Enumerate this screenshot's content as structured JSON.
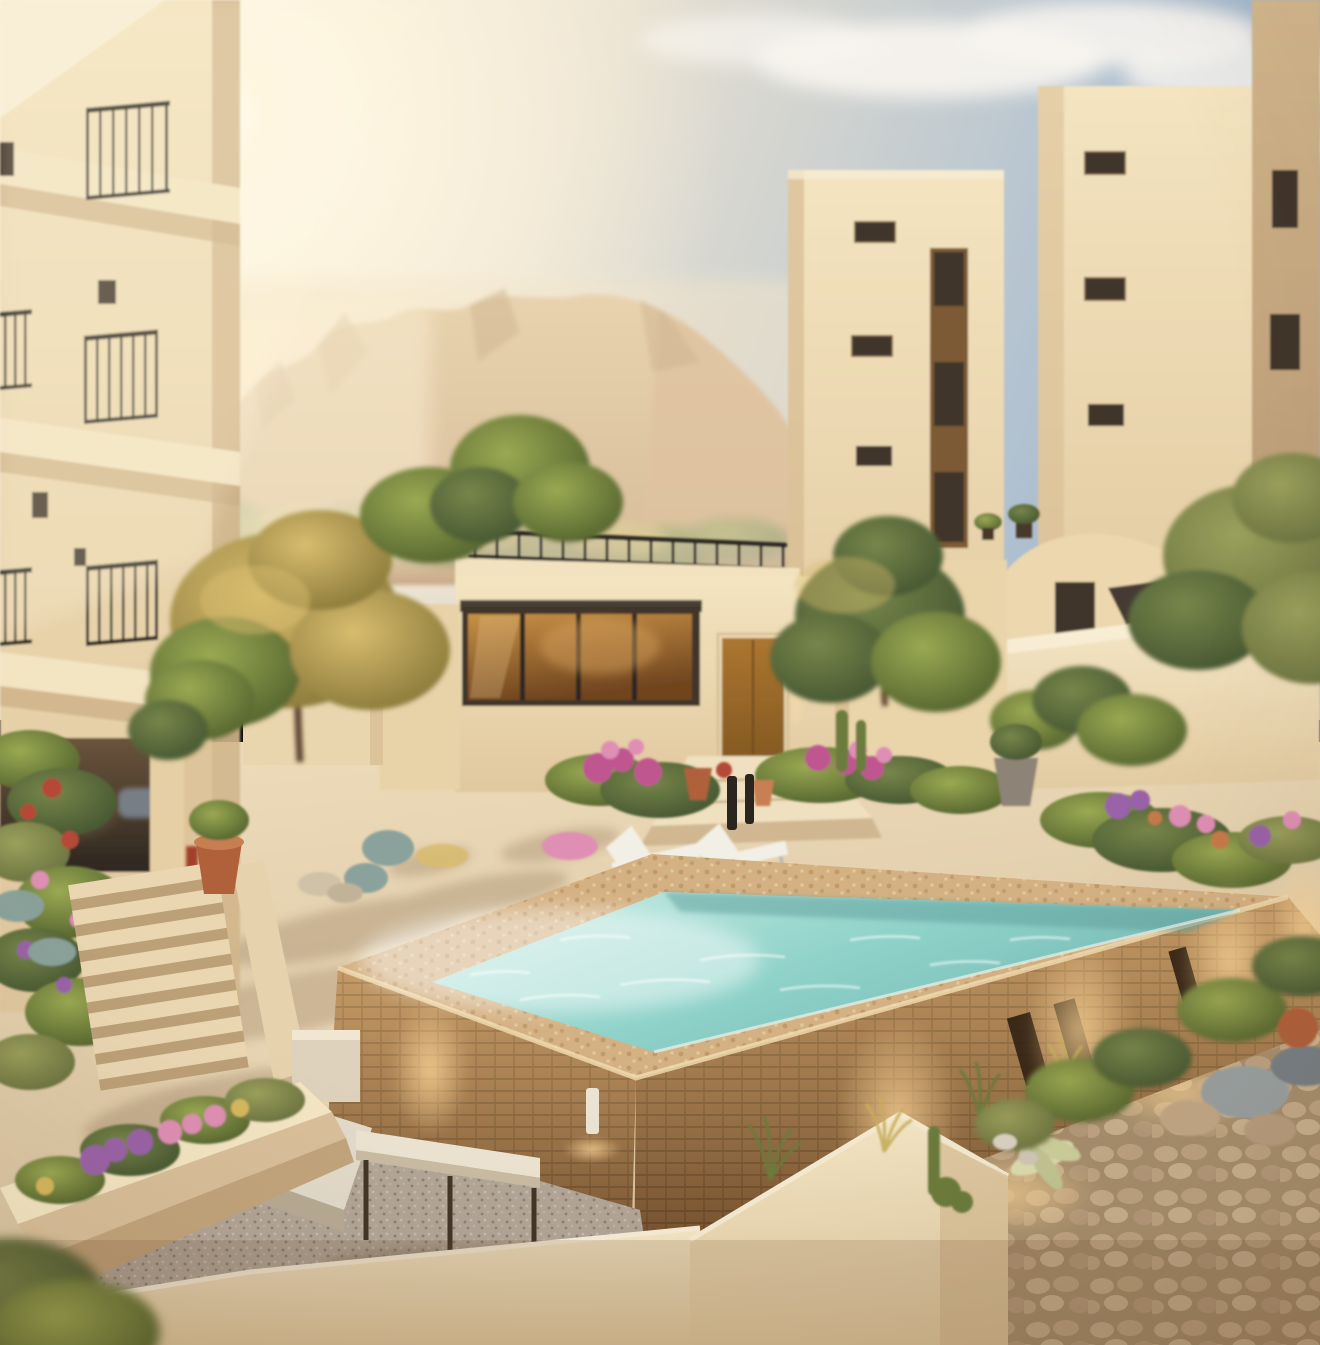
{
  "image": {
    "kind": "photorealistic architectural rendering",
    "subject": "sunlit desert courtyard of a cream stucco apartment complex with a raised brick swimming pool, mountains behind",
    "width_px": 1320,
    "height_px": 1345
  },
  "scene": {
    "regions": [
      "sky",
      "sun-glow",
      "clouds",
      "desert-mountains",
      "foothill-greenery",
      "left-apartment-building",
      "balcony-railings",
      "shaded-walkway",
      "right-apartment-towers",
      "tower-windows",
      "roof-deck-awning",
      "terrace-sofa",
      "central-clubhouse",
      "roof-terrace-railing",
      "picture-window",
      "entry-door",
      "entry-steps",
      "courtyard-garden",
      "trees",
      "flower-beds",
      "terracotta-pot",
      "stone-stairs",
      "raised-brick-pool",
      "pool-water",
      "pool-coping",
      "wall-niches",
      "uplights",
      "lounge-chairs",
      "gravel-patio",
      "garden-bench",
      "patio-table",
      "planter-wall",
      "foreground-wall",
      "rock-cluster",
      "yucca-plants",
      "cobblestone-path"
    ]
  },
  "palette": {
    "sky_warm": "#f7eedb",
    "sky_mid": "#e9e1d1",
    "sky_blue": "#9db6cf",
    "cloud_white": "#f8f5ef",
    "cloud_shadow": "#9db3c9",
    "sun_core": "#fffdf4",
    "sun_glow": "#fff6e0",
    "mountain_top": "#dcc093",
    "mountain_base": "#b99168",
    "ridge_front_top": "#c9a577",
    "ridge_front_base": "#a98058",
    "ridge_shadow": "#a57d52",
    "haze": "#f4e6ca",
    "stucco_light": "#f4e4c0",
    "stucco_base": "#e0c89e",
    "stucco_bright": "#f8eed6",
    "stucco_shade": "#d2b68c",
    "stucco_deep": "#b49571",
    "window_dark": "#41342a",
    "recess_brown": "#7b5a35",
    "glass_amber": "#c79045",
    "glass_deep": "#70451f",
    "door_wood": "#ac7630",
    "door_deep": "#855a22",
    "railing": "#2b2520",
    "awning": "#3a3129",
    "sofa_blue": "#8b9cb2",
    "sofa_blue_light": "#a9b7c7",
    "furniture_dark": "#46392c",
    "corridor_dark": "#2e2720",
    "corridor_warm": "#6b543c",
    "tree_gold": "#d8bc6e",
    "tree_gold_deep": "#8a7a3a",
    "tree_green": "#9aa952",
    "tree_green_deep": "#55652f",
    "tree_dark": "#77864a",
    "tree_dark_deep": "#465732",
    "tree_olive": "#9aa05c",
    "tree_olive_deep": "#6b7340",
    "trunk": "#5f4530",
    "flower_magenta": "#bf5690",
    "flower_pink": "#df8fb4",
    "flower_purple": "#9a62a8",
    "flower_red": "#b44a38",
    "flower_yellow": "#d4b85e",
    "agave_blue": "#8aa29b",
    "terracotta": "#b0613a",
    "terracotta_light": "#c77f52",
    "pot_grey": "#8d8376",
    "paving_light": "#eedcba",
    "paving_base": "#d5bf9c",
    "shadow_warm": "#8a7054",
    "cobble_base": "#a8906f",
    "cobble_stone": "#c6ad8c",
    "gravel_base": "#b2a698",
    "gravel_dark": "#8f8275",
    "brick_base": "#9c6a3e",
    "brick_mortar": "#744d2a",
    "brick_glow": "#ffdf9e",
    "brick_shadow": "#3a2410",
    "coping_sand": "#d4b183",
    "coping_dot": "#c09a68",
    "water_light": "#cdeee6",
    "water_mid": "#8fd2c9",
    "water_deep": "#74bab6",
    "sparkle": "#ffffff",
    "wall_cream": "#f6e8c8",
    "wall_cream_deep": "#e2cba2",
    "bench_white": "#e3dbcb",
    "table_top": "#ece4d2",
    "leg_dark": "#413528",
    "stone_grey": "#9aa2a4",
    "stone_dark": "#778086",
    "stone_tan": "#c4aa88",
    "yucca_pale": "#dfe0b4",
    "cactus_green": "#6c7c3e",
    "glow_warm": "#ffd89a",
    "vignette": "#5a3c19"
  }
}
